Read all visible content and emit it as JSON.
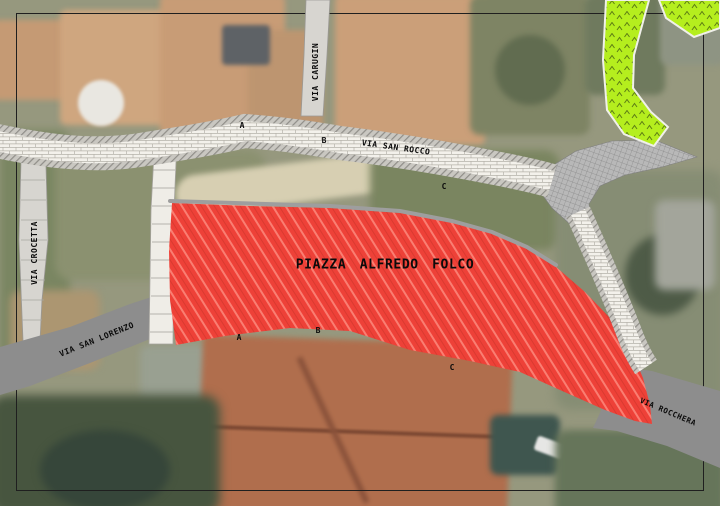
{
  "map": {
    "piazza": {
      "label": "PIAZZA ALFREDO FOLCO"
    },
    "streets": {
      "carugin": "VIA CARUGIN",
      "san_rocco": "VIA SAN ROCCO",
      "crocetta": "VIA CROCETTA",
      "san_lorenzo": "VIA SAN LORENZO",
      "rocchera": "VIA ROCCHERA"
    },
    "markers": {
      "top": [
        {
          "label": "A"
        },
        {
          "label": "B"
        },
        {
          "label": "C"
        }
      ],
      "bottom": [
        {
          "label": "A"
        },
        {
          "label": "B"
        },
        {
          "label": "C"
        }
      ]
    },
    "colors": {
      "piazza_fill": "#ee4138",
      "piazza_hatch_light": "#fa7e72",
      "green_area": "#b5ee1e",
      "road_grey": "#8d8d8d",
      "path_surface": "#f3f1eb",
      "edge_hatch_grey": "#c9c7c1",
      "frame_black": "#1f1f1f"
    }
  }
}
